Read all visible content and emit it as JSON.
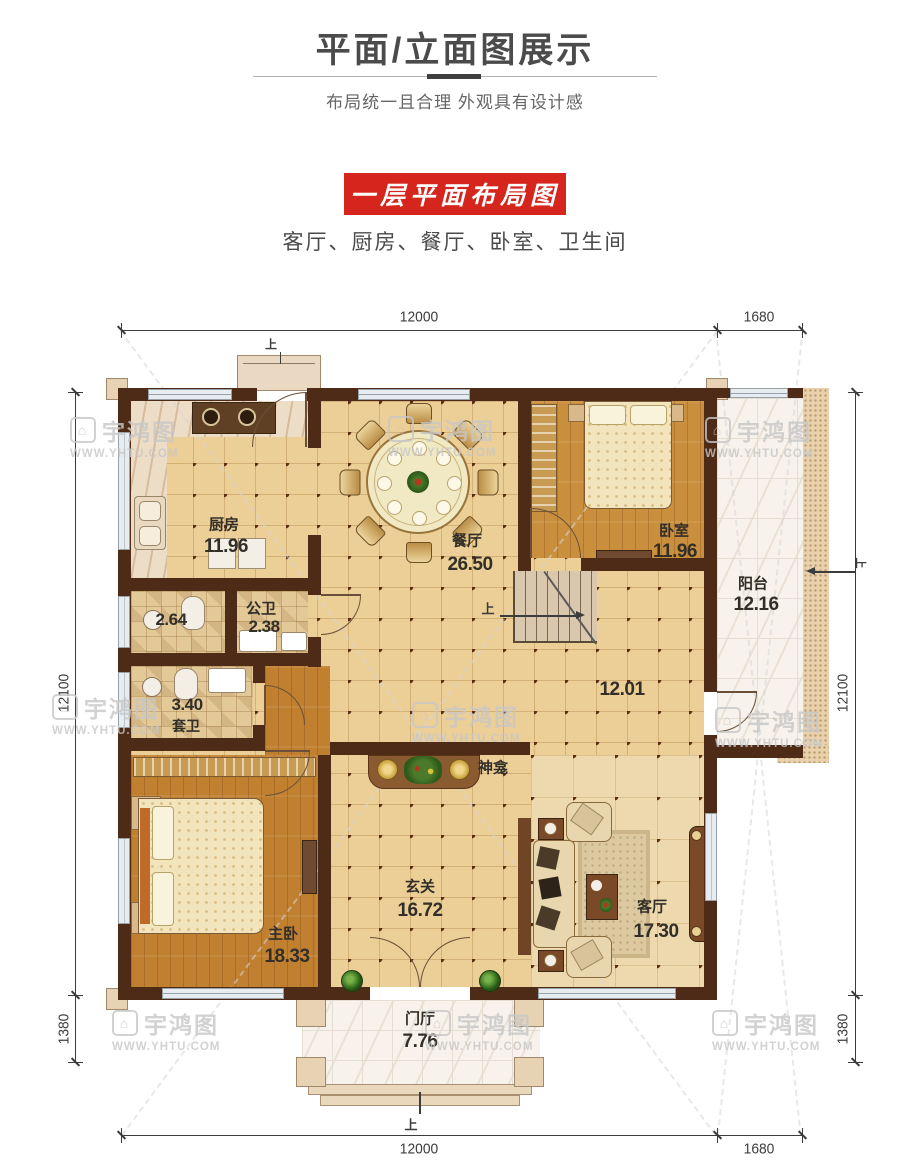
{
  "header": {
    "title": "平面/立面图展示",
    "subtitle": "布局统一且合理 外观具有设计感",
    "banner_title": "一层平面布局图",
    "rooms_line": "客厅、厨房、餐厅、卧室、卫生间"
  },
  "plan": {
    "dimensions": {
      "top": [
        "12000",
        "1680"
      ],
      "bottom": [
        "12000",
        "1680"
      ],
      "left": [
        "12100",
        "1380"
      ],
      "right": [
        "12100",
        "1380"
      ]
    },
    "up_marker": "上",
    "rooms": [
      {
        "id": "kitchen",
        "name": "厨房",
        "area": "11.96"
      },
      {
        "id": "dining",
        "name": "餐厅",
        "area": "26.50"
      },
      {
        "id": "bedroom",
        "name": "卧室",
        "area": "11.96"
      },
      {
        "id": "balcony",
        "name": "阳台",
        "area": "12.16"
      },
      {
        "id": "bath-small",
        "name": "",
        "area": "2.64"
      },
      {
        "id": "bath-public",
        "name": "公卫",
        "area": "2.38"
      },
      {
        "id": "bath-ensuite",
        "name": "套卫",
        "area": "3.40"
      },
      {
        "id": "hallway",
        "name": "",
        "area": "12.01"
      },
      {
        "id": "shrine",
        "name": "神龛",
        "area": ""
      },
      {
        "id": "master",
        "name": "主卧",
        "area": "18.33"
      },
      {
        "id": "living",
        "name": "客厅",
        "area": "17.30"
      },
      {
        "id": "entry",
        "name": "玄关",
        "area": "16.72"
      },
      {
        "id": "porch",
        "name": "门厅",
        "area": "7.76"
      }
    ]
  },
  "watermark": {
    "brand": "宇鸿图",
    "url": "WWW.YHTU.COM"
  },
  "colors": {
    "banner_red": "#d6251d",
    "wall_brown": "#4e2b17",
    "floor_tan": "#ecce97",
    "wood_orange": "#c98f3d",
    "dimension_gray": "#3c3c3c",
    "watermark_gray": "#c7c7c7"
  }
}
